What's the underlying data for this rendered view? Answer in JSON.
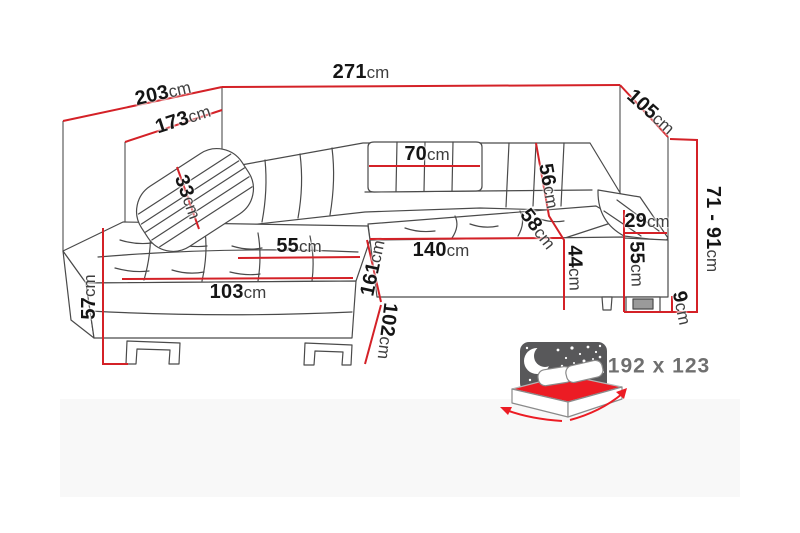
{
  "meta": {
    "description": "Corner sofa dimension diagram",
    "unit": "cm",
    "accent_color": "#d42127",
    "line_color": "#4a4a4a",
    "bed_red": "#ec1c24",
    "headboard_gray": "#58585a"
  },
  "dims": {
    "depth_outer": {
      "num": "203",
      "unit": "cm"
    },
    "depth_inner": {
      "num": "173",
      "unit": "cm"
    },
    "width_total": {
      "num": "271",
      "unit": "cm"
    },
    "side_width": {
      "num": "105",
      "unit": "cm"
    },
    "back_cushion": {
      "num": "70",
      "unit": "cm"
    },
    "pillow": {
      "num": "33",
      "unit": "cm"
    },
    "backrest_height": {
      "num": "56",
      "unit": "cm"
    },
    "seat_depth": {
      "num": "58",
      "unit": "cm"
    },
    "seat_width": {
      "num": "140",
      "unit": "cm"
    },
    "seat_height": {
      "num": "44",
      "unit": "cm"
    },
    "chaise_seat_width": {
      "num": "55",
      "unit": "cm"
    },
    "chaise_length": {
      "num": "161",
      "unit": "cm"
    },
    "chaise_side": {
      "num": "102",
      "unit": "cm"
    },
    "chaise_width": {
      "num": "103",
      "unit": "cm"
    },
    "left_height": {
      "num": "57",
      "unit": "cm"
    },
    "armrest_width": {
      "num": "29",
      "unit": "cm"
    },
    "armrest_height": {
      "num": "55",
      "unit": "cm"
    },
    "total_height": {
      "num": "71 - 91",
      "unit": "cm"
    },
    "leg_height": {
      "num": "9",
      "unit": "cm"
    }
  },
  "sleeping": {
    "label": "192 x 123"
  }
}
